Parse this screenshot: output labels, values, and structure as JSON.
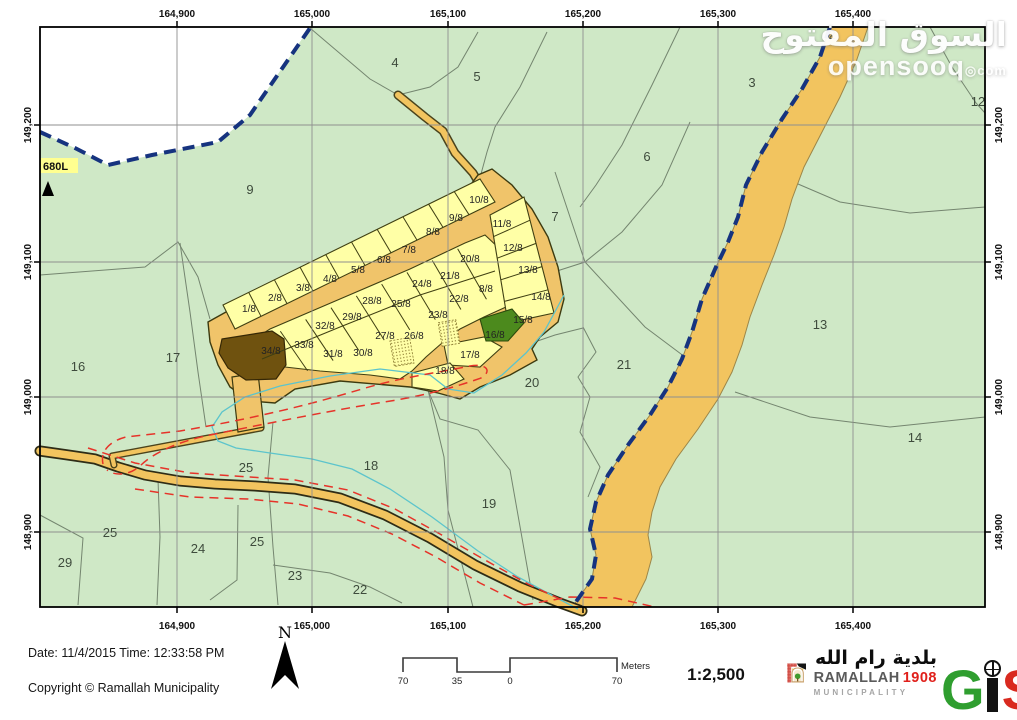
{
  "watermark": {
    "arabic": "السوق المفتوح",
    "site": "opensooq",
    "tld": "com"
  },
  "map": {
    "x_ticks": [
      "164,900",
      "165,000",
      "165,100",
      "165,200",
      "165,300",
      "165,400"
    ],
    "y_ticks": [
      "149,200",
      "149,100",
      "149,000",
      "148,900"
    ],
    "landmark": "680L",
    "area_labels": [
      {
        "t": "2",
        "x": 792,
        "y": 12
      },
      {
        "t": "4",
        "x": 355,
        "y": 40
      },
      {
        "t": "5",
        "x": 437,
        "y": 54
      },
      {
        "t": "3",
        "x": 712,
        "y": 60
      },
      {
        "t": "12",
        "x": 938,
        "y": 79
      },
      {
        "t": "6",
        "x": 607,
        "y": 134
      },
      {
        "t": "9",
        "x": 210,
        "y": 167
      },
      {
        "t": "7",
        "x": 515,
        "y": 194
      },
      {
        "t": "13",
        "x": 780,
        "y": 302
      },
      {
        "t": "16",
        "x": 38,
        "y": 344
      },
      {
        "t": "17",
        "x": 133,
        "y": 335
      },
      {
        "t": "21",
        "x": 584,
        "y": 342
      },
      {
        "t": "20",
        "x": 492,
        "y": 360
      },
      {
        "t": "14",
        "x": 875,
        "y": 415
      },
      {
        "t": "25",
        "x": 206,
        "y": 445
      },
      {
        "t": "18",
        "x": 331,
        "y": 443
      },
      {
        "t": "19",
        "x": 449,
        "y": 481
      },
      {
        "t": "25",
        "x": 70,
        "y": 510
      },
      {
        "t": "24",
        "x": 158,
        "y": 526
      },
      {
        "t": "25",
        "x": 217,
        "y": 519
      },
      {
        "t": "29",
        "x": 25,
        "y": 540
      },
      {
        "t": "23",
        "x": 255,
        "y": 553
      },
      {
        "t": "22",
        "x": 320,
        "y": 567
      }
    ],
    "plot_labels": [
      {
        "t": "1/8",
        "x": 209,
        "y": 285
      },
      {
        "t": "2/8",
        "x": 235,
        "y": 274
      },
      {
        "t": "3/8",
        "x": 263,
        "y": 264
      },
      {
        "t": "4/8",
        "x": 290,
        "y": 255
      },
      {
        "t": "5/8",
        "x": 318,
        "y": 246
      },
      {
        "t": "6/8",
        "x": 344,
        "y": 236
      },
      {
        "t": "7/8",
        "x": 369,
        "y": 226
      },
      {
        "t": "8/8",
        "x": 393,
        "y": 208
      },
      {
        "t": "9/8",
        "x": 416,
        "y": 194
      },
      {
        "t": "10/8",
        "x": 439,
        "y": 176
      },
      {
        "t": "11/8",
        "x": 462,
        "y": 200
      },
      {
        "t": "12/8",
        "x": 473,
        "y": 224
      },
      {
        "t": "13/8",
        "x": 488,
        "y": 246
      },
      {
        "t": "14/8",
        "x": 501,
        "y": 273
      },
      {
        "t": "15/8",
        "x": 483,
        "y": 296
      },
      {
        "t": "20/8",
        "x": 430,
        "y": 235
      },
      {
        "t": "21/8",
        "x": 410,
        "y": 252
      },
      {
        "t": "24/8",
        "x": 382,
        "y": 260
      },
      {
        "t": "8/8",
        "x": 446,
        "y": 265
      },
      {
        "t": "22/8",
        "x": 419,
        "y": 275
      },
      {
        "t": "25/8",
        "x": 361,
        "y": 280
      },
      {
        "t": "28/8",
        "x": 332,
        "y": 277
      },
      {
        "t": "23/8",
        "x": 398,
        "y": 291
      },
      {
        "t": "29/8",
        "x": 312,
        "y": 293
      },
      {
        "t": "32/8",
        "x": 285,
        "y": 302
      },
      {
        "t": "33/8",
        "x": 264,
        "y": 321
      },
      {
        "t": "34/8",
        "x": 231,
        "y": 327,
        "c": "#2e2506"
      },
      {
        "t": "31/8",
        "x": 293,
        "y": 330
      },
      {
        "t": "30/8",
        "x": 323,
        "y": 329
      },
      {
        "t": "27/8",
        "x": 345,
        "y": 312
      },
      {
        "t": "26/8",
        "x": 374,
        "y": 312
      },
      {
        "t": "16/8",
        "x": 455,
        "y": 311,
        "c": "#16300a"
      },
      {
        "t": "17/8",
        "x": 430,
        "y": 331
      },
      {
        "t": "18/8",
        "x": 405,
        "y": 347
      }
    ]
  },
  "footer": {
    "date_line": "Date: 11/4/2015 Time: 12:33:58 PM",
    "copyright_line": "Copyright © Ramallah Municipality",
    "north_label": "N",
    "scale_ticks": [
      "70",
      "35",
      "0",
      "70"
    ],
    "scale_unit": "Meters",
    "scale_ratio": "1:2,500",
    "logo": {
      "arabic": "بلدية رام الله",
      "name": "RAMALLAH",
      "year": "1908",
      "subtitle": "MUNICIPALITY",
      "gis_g": "G",
      "gis_s": "S",
      "gis_label": "GIS"
    }
  },
  "colors": {
    "land": "#cfe8c6",
    "road": "#f2c45f",
    "plot_yellow": "#ffffa6",
    "plot_dark": "#6f520f",
    "plot_green": "#4c8a1d",
    "boundary_blue": "#16337f",
    "parcel_line": "#74856f",
    "red_dash": "#e63329",
    "stream_cyan": "#5cc4cc",
    "grid": "#8f8f8f"
  }
}
